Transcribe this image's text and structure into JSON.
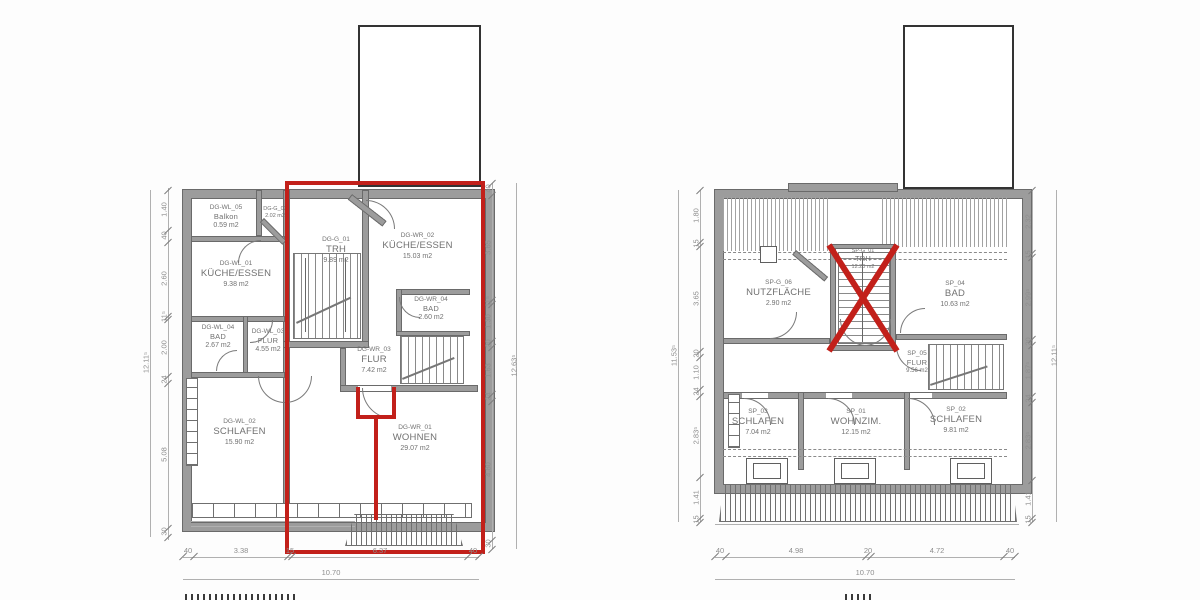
{
  "colors": {
    "highlight_red": "#c2201a",
    "wall_gray": "#9c9c9c"
  },
  "left_plan": {
    "rooms": {
      "balkon": {
        "id": "DG-WL_05",
        "name": "Balkon",
        "area": "0.59 m2"
      },
      "abst": {
        "id": "DG-G_02",
        "name": "",
        "area": "2.02 m2"
      },
      "trh": {
        "id": "DG-G_01",
        "name": "TRH",
        "area": "9.89 m2"
      },
      "kueche_wl": {
        "id": "DG-WL_01",
        "name": "KÜCHE/ESSEN",
        "area": "9.38 m2"
      },
      "kueche_wr": {
        "id": "DG-WR_02",
        "name": "KÜCHE/ESSEN",
        "area": "15.03 m2"
      },
      "bad_wl": {
        "id": "DG-WL_04",
        "name": "BAD",
        "area": "2.67 m2"
      },
      "flur_wl": {
        "id": "DG-WL_03",
        "name": "FLUR",
        "area": "4.55 m2"
      },
      "bad_wr": {
        "id": "DG-WR_04",
        "name": "BAD",
        "area": "2.60 m2"
      },
      "flur_wr": {
        "id": "DG-WR_03",
        "name": "FLUR",
        "area": "7.42 m2"
      },
      "schlafen": {
        "id": "DG-WL_02",
        "name": "SCHLAFEN",
        "area": "15.90 m2"
      },
      "wohnen": {
        "id": "DG-WR_01",
        "name": "WOHNEN",
        "area": "29.07 m2"
      }
    },
    "dims": {
      "left_chain": [
        "1.40",
        "40",
        "2.60",
        "11⁵",
        "2.00",
        "24",
        "5.08",
        "30"
      ],
      "left_outer": "12.11⁵",
      "right_chain": [
        "40",
        "3.65",
        "11⁵",
        "1.30",
        "20",
        "1.63",
        "24",
        "4.80",
        "30"
      ],
      "right_outer": "12.63⁵",
      "bottom_chain": [
        "40",
        "3.38",
        "15",
        "6.37",
        "40"
      ],
      "bottom_outer": "10.70"
    }
  },
  "right_plan": {
    "rooms": {
      "nutzflaeche": {
        "id": "SP-G_06",
        "name": "NUTZFLÄCHE",
        "area": "2.90 m2"
      },
      "trh": {
        "id": "SP-G_01",
        "name": "TRH",
        "area": "12.20 m2"
      },
      "bad": {
        "id": "SP_04",
        "name": "BAD",
        "area": "10.63 m2"
      },
      "flur": {
        "id": "SP_05",
        "name": "FLUR",
        "area": "9.56 m2"
      },
      "schlafen_l": {
        "id": "SP_03",
        "name": "SCHLAFEN",
        "area": "7.04 m2"
      },
      "wohnzim": {
        "id": "SP_01",
        "name": "WOHNZIM.",
        "area": "12.15 m2"
      },
      "schlafen_r": {
        "id": "SP_02",
        "name": "SCHLAFEN",
        "area": "9.81 m2"
      }
    },
    "dims": {
      "left_chain": [
        "1.80",
        "15",
        "3.65",
        "20",
        "1.10",
        "24",
        "2.83⁵",
        "1.41",
        "15"
      ],
      "left_outer": "11.53⁵",
      "right_chain": [
        "2.32",
        "15",
        "2.99⁵",
        "20",
        "1.87⁵",
        "24",
        "2.83⁵",
        "1.41",
        "15"
      ],
      "right_outer": "12.11⁵",
      "bottom_chain": [
        "40",
        "4.98",
        "20",
        "4.72",
        "40"
      ],
      "bottom_outer": "10.70"
    }
  }
}
